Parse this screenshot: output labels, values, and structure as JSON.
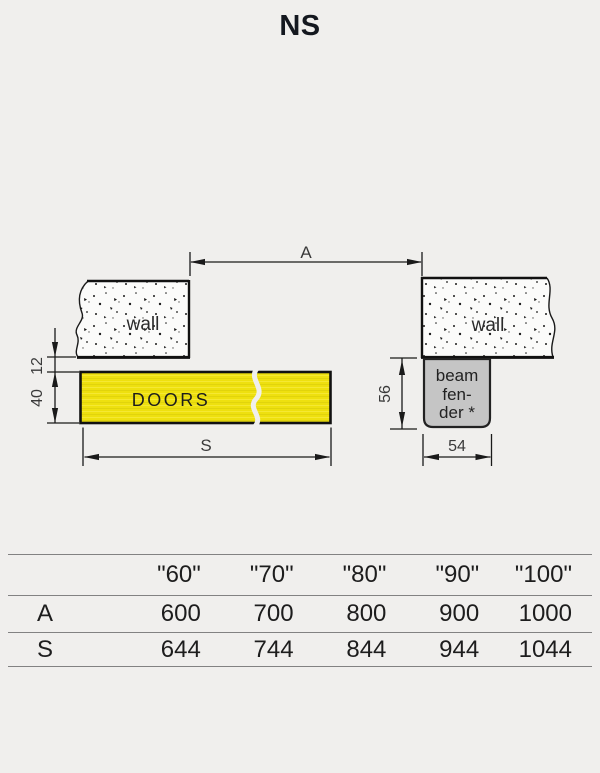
{
  "title": "NS",
  "diagram": {
    "labels": {
      "wall_left": "wall",
      "wall_right": "wall",
      "doors": "DOORS",
      "beam_fender_line1": "beam",
      "beam_fender_line2": "fen-",
      "beam_fender_line3": "der *"
    },
    "dimensions": {
      "a": "A",
      "s": "S",
      "gap_wall_to_door": "12",
      "door_thickness": "40",
      "fender_height": "56",
      "fender_width": "54"
    },
    "colors": {
      "doors_fill": "#eee00f",
      "fender_fill": "#c5c5c5",
      "line": "#1a1a1a",
      "background": "#f0efed"
    }
  },
  "table": {
    "headers": [
      "",
      "\"60\"",
      "\"70\"",
      "\"80\"",
      "\"90\"",
      "\"100\""
    ],
    "rows": [
      {
        "label": "A",
        "values": [
          "600",
          "700",
          "800",
          "900",
          "1000"
        ]
      },
      {
        "label": "S",
        "values": [
          "644",
          "744",
          "844",
          "944",
          "1044"
        ]
      }
    ]
  }
}
